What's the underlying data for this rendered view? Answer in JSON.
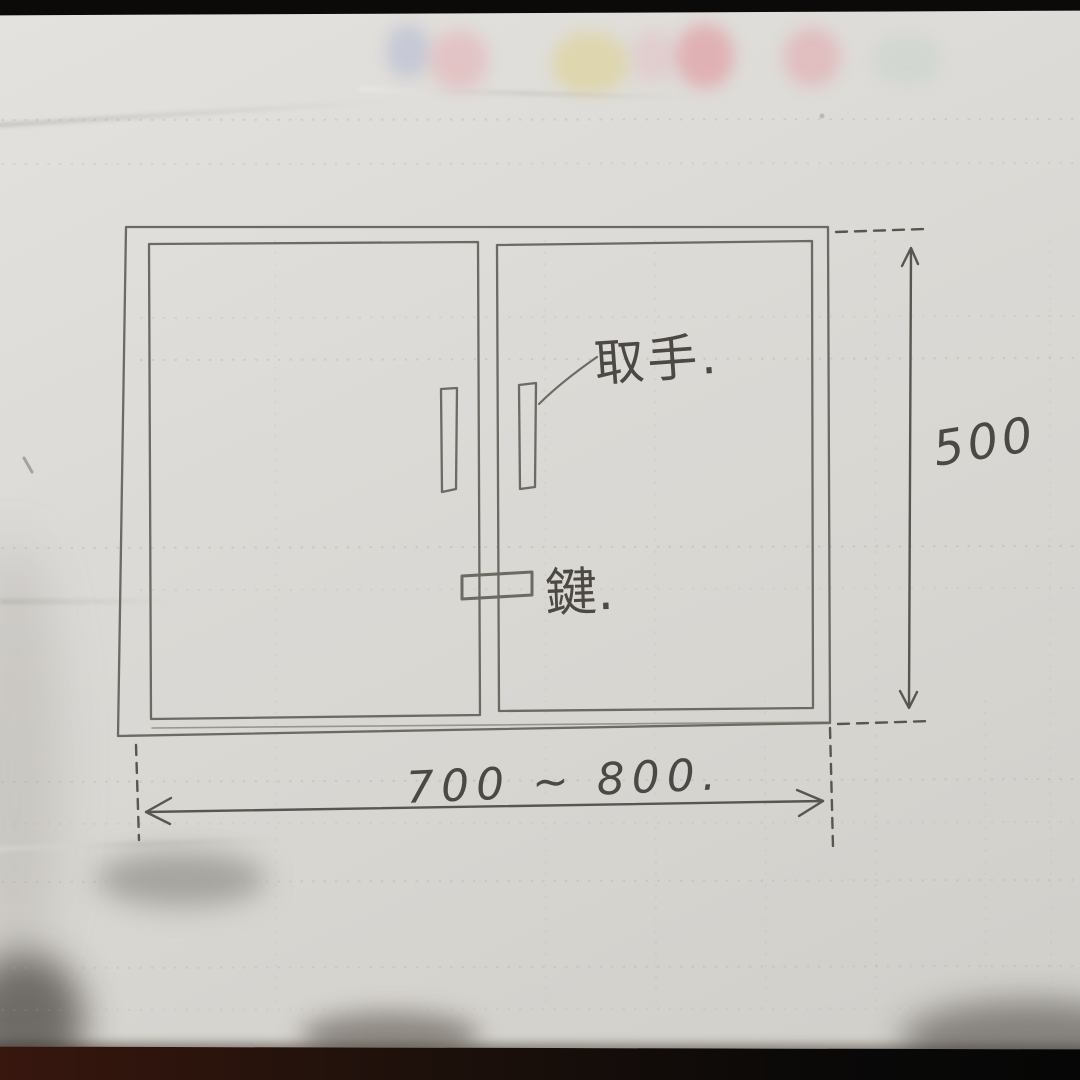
{
  "photo": {
    "subject": "hand-drawn pencil sketch of a two-door cabinet front with dimensions",
    "labels": {
      "handle": "取手.",
      "lock": "鍵."
    },
    "dimensions": {
      "height": "500",
      "width": "700 ~ 800."
    },
    "colors": {
      "paper": "#dad8d4",
      "pencil": "#6d6963",
      "handwriting": "#4c4843",
      "table": "#0b0a09"
    }
  }
}
